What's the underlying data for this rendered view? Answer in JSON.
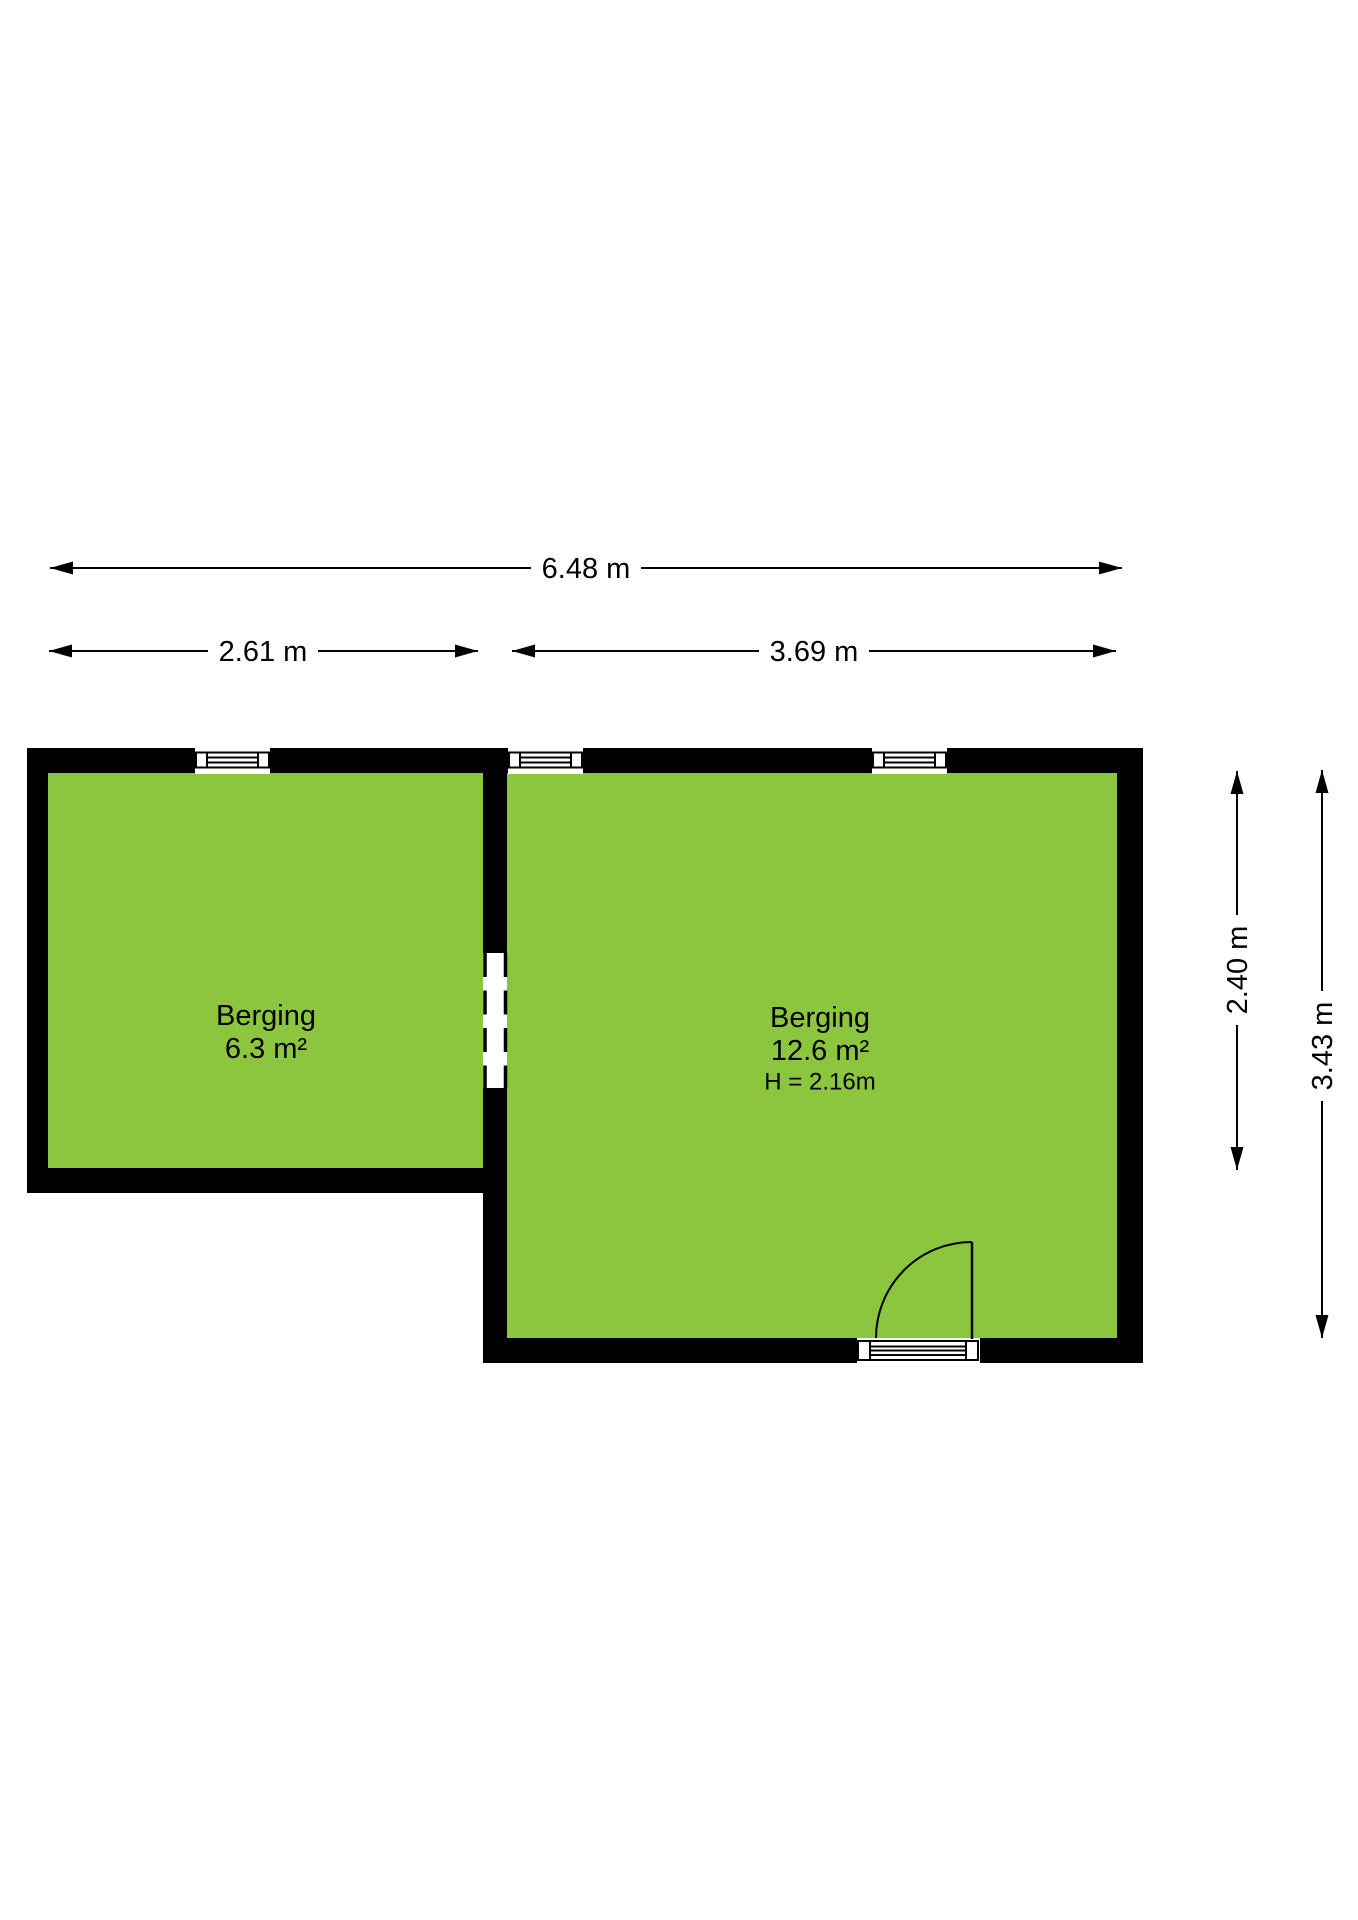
{
  "floorplan": {
    "colors": {
      "floor": "#8cc63e",
      "wall": "#000000",
      "dimension_line": "#000000",
      "text": "#000000",
      "background": "#ffffff"
    },
    "dimensions": {
      "total_width": "6.48 m",
      "room1_width": "2.61 m",
      "room2_width": "3.69 m",
      "room1_height": "2.40 m",
      "room2_height": "3.43 m"
    },
    "rooms": [
      {
        "name": "Berging",
        "area": "6.3 m²"
      },
      {
        "name": "Berging",
        "area": "12.6 m²",
        "ceiling_height": "H = 2.16m"
      }
    ]
  }
}
